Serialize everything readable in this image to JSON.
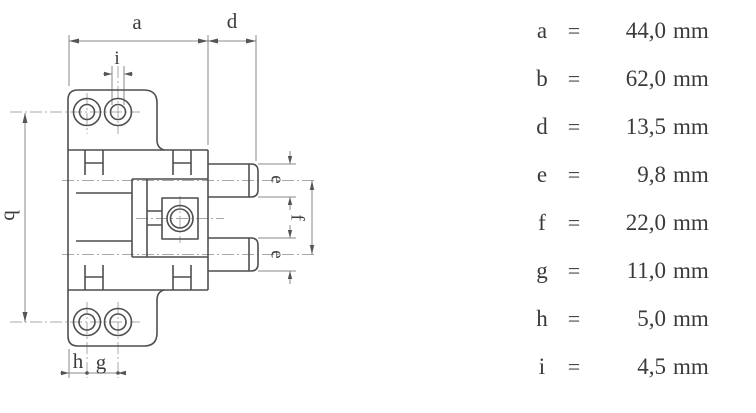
{
  "drawing": {
    "labels": {
      "a": "a",
      "b": "b",
      "d": "d",
      "e_top": "e",
      "e_bottom": "e",
      "f": "f",
      "g": "g",
      "h": "h",
      "i": "i"
    }
  },
  "table": {
    "equals": "=",
    "rows": [
      {
        "sym": "a",
        "value": "44,0",
        "unit": "mm"
      },
      {
        "sym": "b",
        "value": "62,0",
        "unit": "mm"
      },
      {
        "sym": "d",
        "value": "13,5",
        "unit": "mm"
      },
      {
        "sym": "e",
        "value": "9,8",
        "unit": "mm"
      },
      {
        "sym": "f",
        "value": "22,0",
        "unit": "mm"
      },
      {
        "sym": "g",
        "value": "11,0",
        "unit": "mm"
      },
      {
        "sym": "h",
        "value": "5,0",
        "unit": "mm"
      },
      {
        "sym": "i",
        "value": "4,5",
        "unit": "mm"
      }
    ]
  },
  "colors": {
    "background": "#ffffff",
    "outline": "#4f4f4f",
    "dimension": "#8a8a8a",
    "centerline": "#a8a8a8",
    "text": "#3a3a3a"
  }
}
